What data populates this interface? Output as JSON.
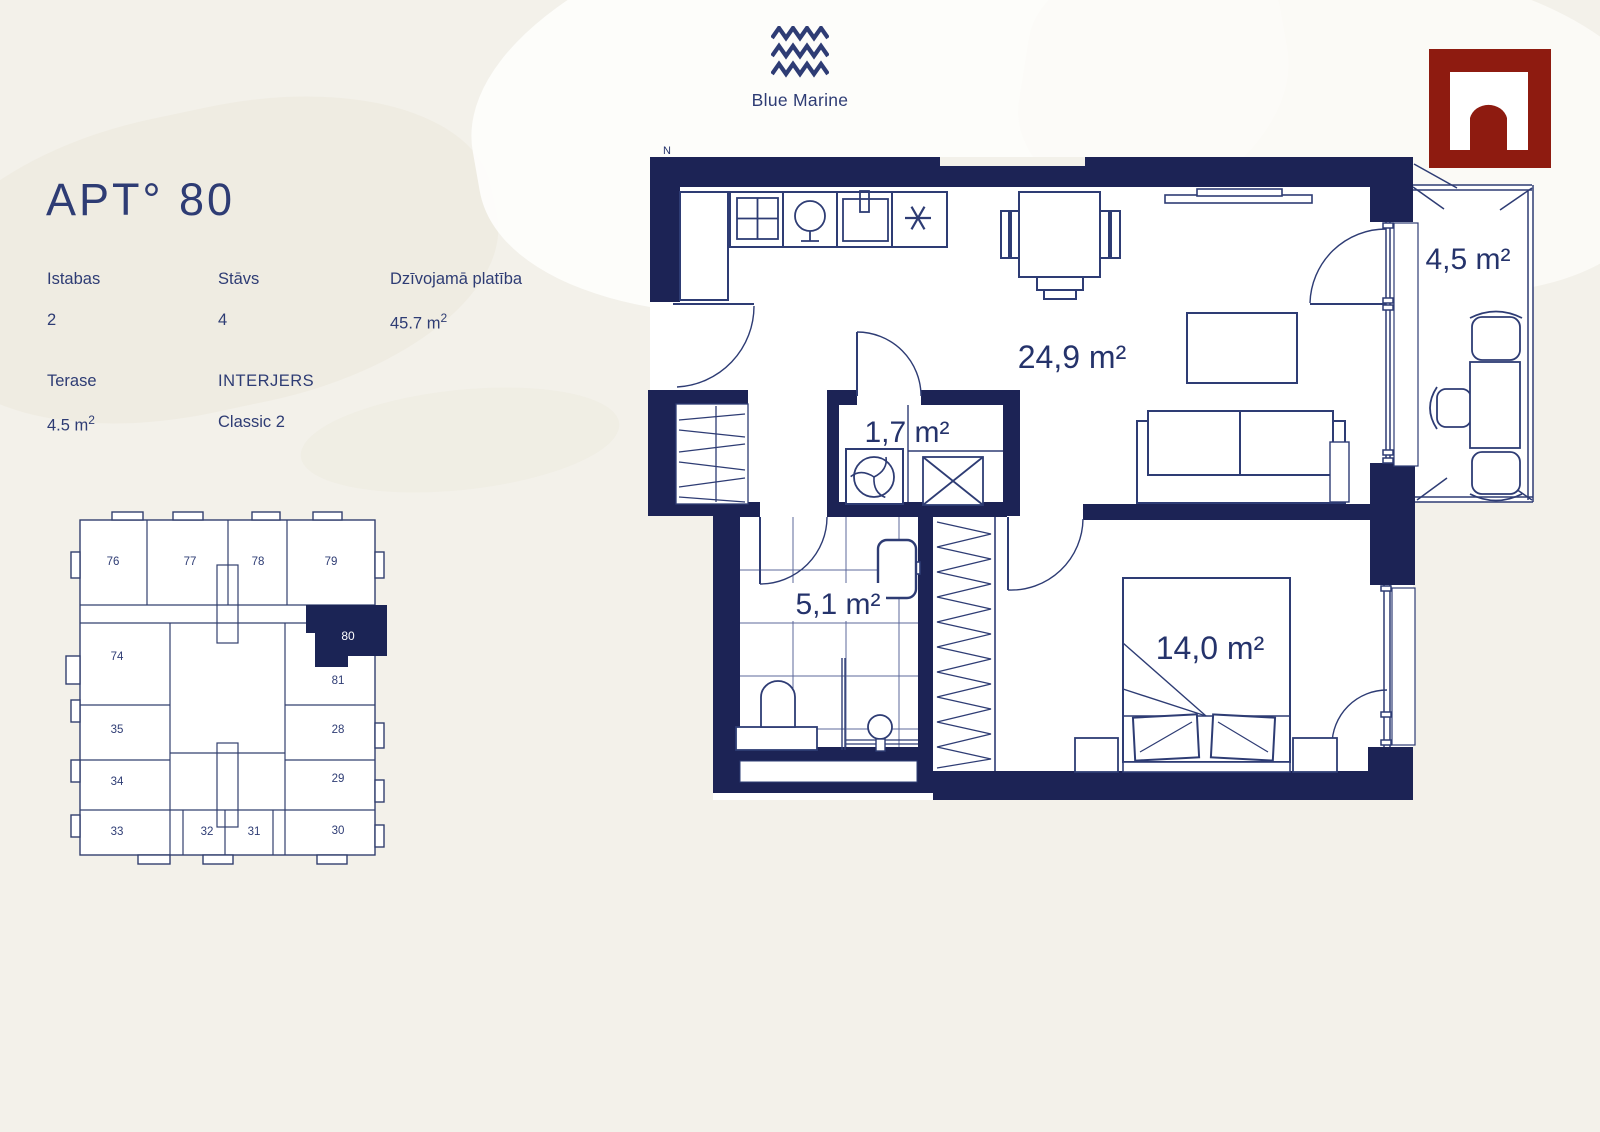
{
  "brand": {
    "name": "Blue Marine"
  },
  "watermark": {
    "name": "arch-logo"
  },
  "apartment": {
    "title": "APT° 80",
    "info": {
      "rooms_label": "Istabas",
      "rooms_value": "2",
      "floor_label": "Stāvs",
      "floor_value": "4",
      "area_label": "Dzīvojamā platība",
      "area_value": "45.7 m",
      "area_sup": "2",
      "terrace_label": "Terase",
      "terrace_value": "4.5 m",
      "terrace_sup": "2",
      "interior_label": "INTERJERS",
      "interior_value": "Classic 2"
    }
  },
  "plan": {
    "north_label": "N",
    "rooms": {
      "living": "24,9 m²",
      "tech": "1,7 m²",
      "bathroom": "5,1 m²",
      "bedroom": "14,0 m²",
      "terrace": "4,5 m²"
    }
  },
  "site_map": {
    "highlighted_unit": "80",
    "units": [
      "76",
      "77",
      "78",
      "79",
      "74",
      "80",
      "81",
      "35",
      "28",
      "34",
      "29",
      "33",
      "32",
      "31",
      "30"
    ]
  },
  "colors": {
    "navy": "#1c2355",
    "line": "#2e3c74",
    "red": "#8e1b10",
    "background": "#f3f1ea"
  }
}
